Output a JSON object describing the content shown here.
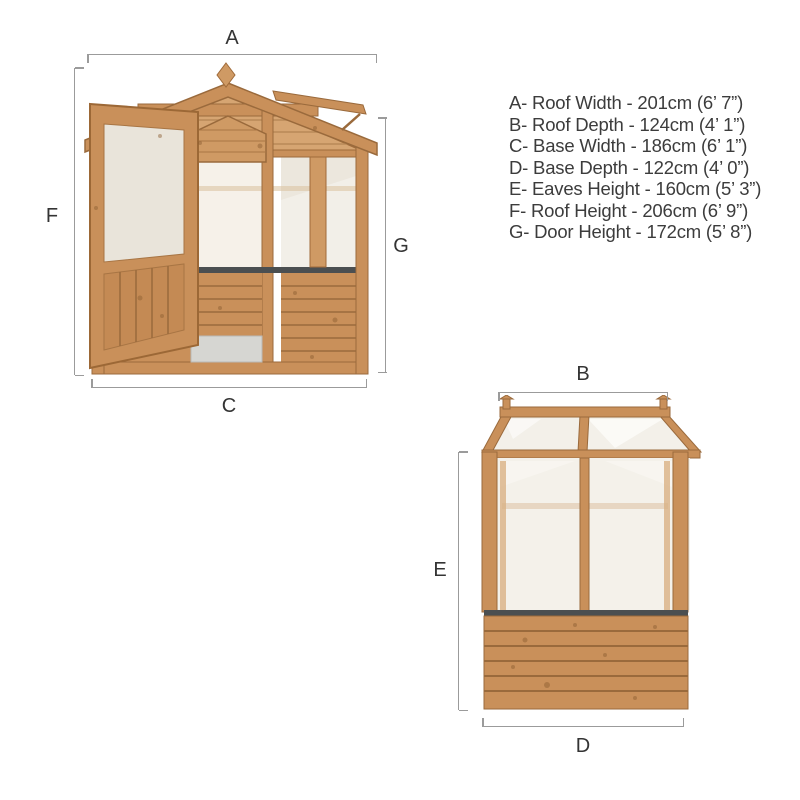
{
  "legend": {
    "items": [
      "A- Roof Width - 201cm (6’ 7”)",
      "B- Roof Depth - 124cm (4’ 1”)",
      "C- Base Width - 186cm (6’ 1”)",
      "D- Base Depth - 122cm (4’ 0”)",
      "E- Eaves Height - 160cm (5’ 3”)",
      "F- Roof Height - 206cm (6’ 9”)",
      "G- Door Height - 172cm (5’ 8”)"
    ]
  },
  "dimensions": {
    "front": {
      "top": "A",
      "left": "F",
      "right": "G",
      "bottom": "C"
    },
    "side": {
      "top": "B",
      "left": "E",
      "bottom": "D"
    }
  },
  "colors": {
    "wood": "#c9905a",
    "wood_light": "#d6a572",
    "wood_dark": "#9a6a3c",
    "glazing": "#f4f1ea",
    "sill": "#4b4f51",
    "ramp": "#d6d6d2",
    "dimension_line": "#9b9b9b",
    "text": "#3c3c3c",
    "background": "#ffffff"
  }
}
